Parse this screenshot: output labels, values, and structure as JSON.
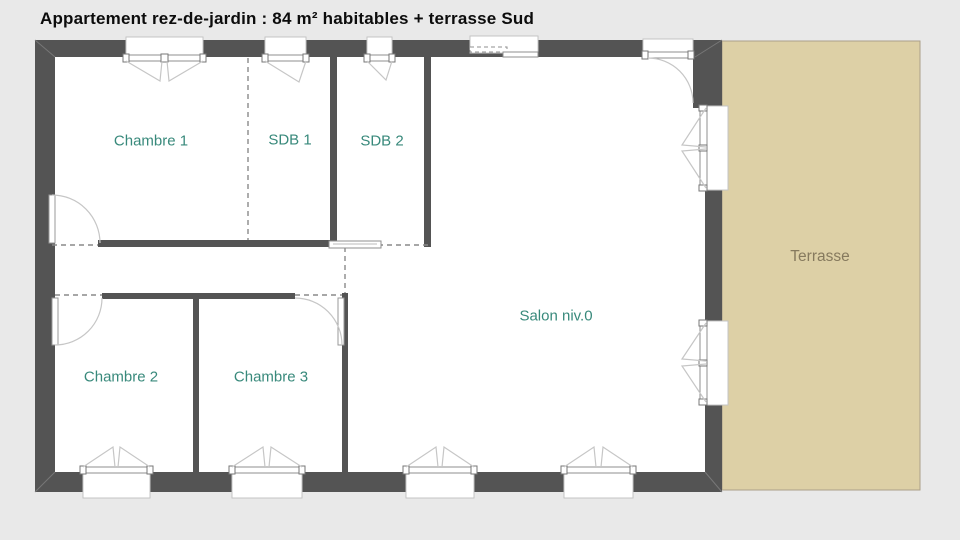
{
  "title": "Appartement rez-de-jardin : 84 m² habitables + terrasse Sud",
  "rooms": {
    "chambre1": {
      "label": "Chambre 1"
    },
    "sdb1": {
      "label": "SDB 1"
    },
    "sdb2": {
      "label": "SDB 2"
    },
    "salon": {
      "label": "Salon niv.0"
    },
    "chambre2": {
      "label": "Chambre 2"
    },
    "chambre3": {
      "label": "Chambre 3"
    },
    "terrasse": {
      "label": "Terrasse"
    }
  },
  "colors": {
    "background": "#E9E9E9",
    "wall": "#545454",
    "room_fill": "#FFFFFF",
    "room_label": "#38897B",
    "terrace_fill": "#DDD0A6",
    "terrace_border": "#ABA089",
    "terrace_label": "#867A5E",
    "title": "#0C0C0C"
  }
}
